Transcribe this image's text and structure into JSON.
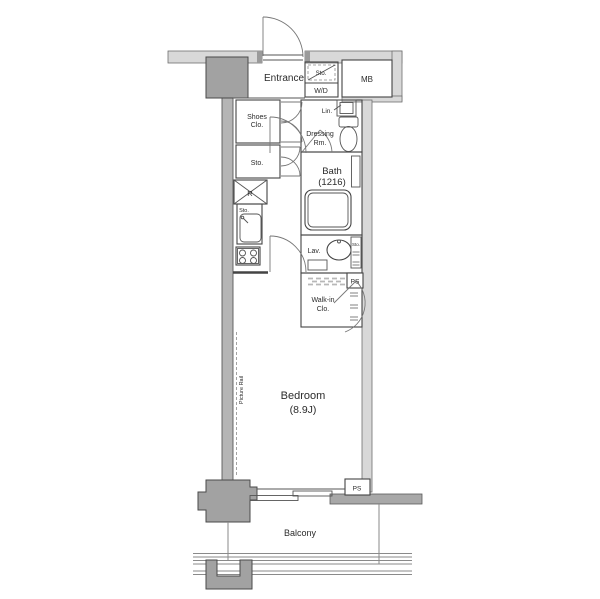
{
  "floor_plan": {
    "rooms": {
      "entrance": {
        "label": "Entrance"
      },
      "storage_upper": {
        "label": "Sto."
      },
      "washer_dryer": {
        "label": "W/D"
      },
      "meter_box": {
        "label": "MB"
      },
      "shoes_closet": {
        "label_line1": "Shoes",
        "label_line2": "Clo."
      },
      "hall_storage": {
        "label": "Sto."
      },
      "linen": {
        "label": "Lin."
      },
      "dressing_room": {
        "label_line1": "Dressing",
        "label_line2": "Rm."
      },
      "bath": {
        "label": "Bath",
        "size": "(1216)"
      },
      "refrigerator": {
        "label": "R"
      },
      "kitchen_storage": {
        "label": "Sto."
      },
      "lavatory": {
        "label": "Lav."
      },
      "lavatory_storage": {
        "label": "Sto."
      },
      "pipe_space_upper": {
        "label": "PS"
      },
      "walk_in_closet": {
        "label_line1": "Walk-in",
        "label_line2": "Clo."
      },
      "bedroom": {
        "label": "Bedroom",
        "size": "(8.9J)"
      },
      "picture_rail": {
        "label": "Picture Rail"
      },
      "pipe_space_lower": {
        "label": "PS"
      },
      "balcony": {
        "label": "Balcony"
      }
    },
    "colors": {
      "outline": "#444444",
      "wall_light": "#d8d8d8",
      "wall_medium": "#b5b5b5",
      "pillar": "#a2a2a2",
      "background": "#ffffff",
      "hatch": "#b8b8b8"
    }
  }
}
